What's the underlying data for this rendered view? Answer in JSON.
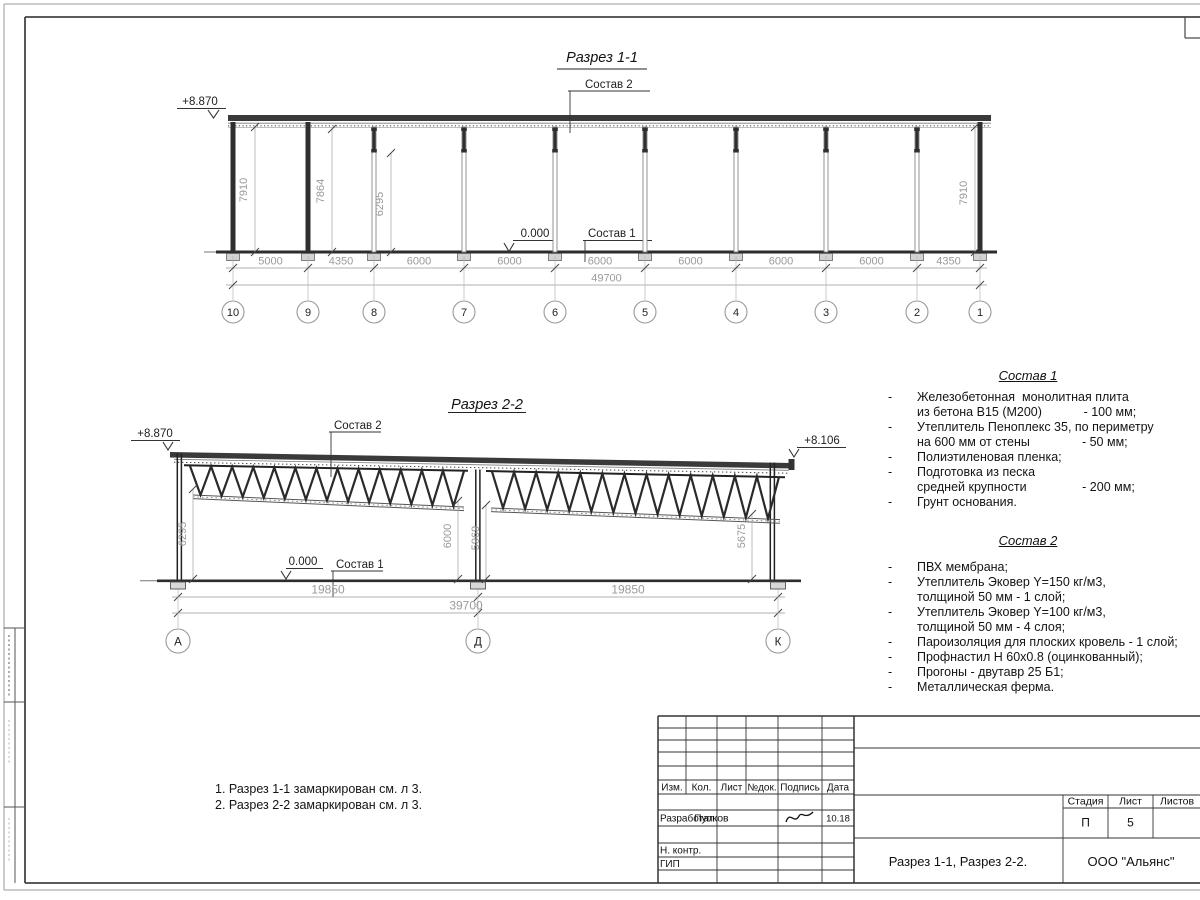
{
  "section1": {
    "title": "Разрез 1-1",
    "elevation": "+8.870",
    "zero_level": "0.000",
    "leader_top": "Состав 2",
    "leader_bottom": "Состав 1",
    "height_dims": [
      "7910",
      "7864",
      "6295",
      "7910"
    ],
    "span_dims": [
      "5000",
      "4350",
      "6000",
      "6000",
      "6000",
      "6000",
      "6000",
      "6000",
      "4350"
    ],
    "total_dim": "49700",
    "grids": [
      "10",
      "9",
      "8",
      "7",
      "6",
      "5",
      "4",
      "3",
      "2",
      "1"
    ]
  },
  "section2": {
    "title": "Разрез 2-2",
    "elevation_left": "+8.870",
    "elevation_right": "+8.106",
    "zero_level": "0.000",
    "leader_top": "Состав 2",
    "leader_bottom": "Состав 1",
    "height_dims": [
      "6295",
      "6000",
      "5969",
      "5675"
    ],
    "span_dims": [
      "19850",
      "19850"
    ],
    "total_dim": "39700",
    "grids": [
      "А",
      "Д",
      "К"
    ]
  },
  "sostav1": {
    "heading": "Состав 1",
    "lines": [
      {
        "dash": "-",
        "text": "Железобетонная  монолитная плита"
      },
      {
        "dash": "",
        "text": "из бетона В15 (М200)            - 100 мм;"
      },
      {
        "dash": "-",
        "text": "Утеплитель Пеноплекс 35, по периметру"
      },
      {
        "dash": "",
        "text": "на 600 мм от стены               - 50 мм;"
      },
      {
        "dash": "-",
        "text": "Полиэтиленовая пленка;"
      },
      {
        "dash": "-",
        "text": "Подготовка из песка"
      },
      {
        "dash": "",
        "text": "средней крупности                - 200 мм;"
      },
      {
        "dash": "-",
        "text": "Грунт основания."
      }
    ]
  },
  "sostav2": {
    "heading": "Состав 2",
    "lines": [
      {
        "dash": "-",
        "text": "ПВХ мембрана;"
      },
      {
        "dash": "-",
        "text": "Утеплитель Эковер Y=150 кг/м3,"
      },
      {
        "dash": "",
        "text": "толщиной 50 мм - 1 слой;"
      },
      {
        "dash": "-",
        "text": "Утеплитель Эковер Y=100 кг/м3,"
      },
      {
        "dash": "",
        "text": "толщиной 50 мм - 4 слоя;"
      },
      {
        "dash": "-",
        "text": "Пароизоляция для плоских кровель - 1 слой;"
      },
      {
        "dash": "-",
        "text": "Профнастил Н 60х0.8 (оцинкованный);"
      },
      {
        "dash": "-",
        "text": "Прогоны - двутавр 25 Б1;"
      },
      {
        "dash": "-",
        "text": "Металлическая ферма."
      }
    ]
  },
  "notes": [
    "1. Разрез 1-1 замаркирован см. л 3.",
    "2. Разрез 2-2 замаркирован см. л 3."
  ],
  "titleblock": {
    "columns": [
      "Изм.",
      "Кол.",
      "Лист",
      "№док.",
      "Подпись",
      "Дата"
    ],
    "developer_role": "Разработал",
    "developer_name": "Пупков",
    "developer_date": "10.18",
    "ncontr": "Н. контр.",
    "gip": "ГИП",
    "stage_label": "Стадия",
    "sheet_label": "Лист",
    "sheets_label": "Листов",
    "stage_value": "П",
    "sheet_value": "5",
    "sheets_value": "",
    "doc_title": "Разрез 1-1, Разрез 2-2.",
    "company": "ООО \"Альянс\""
  }
}
